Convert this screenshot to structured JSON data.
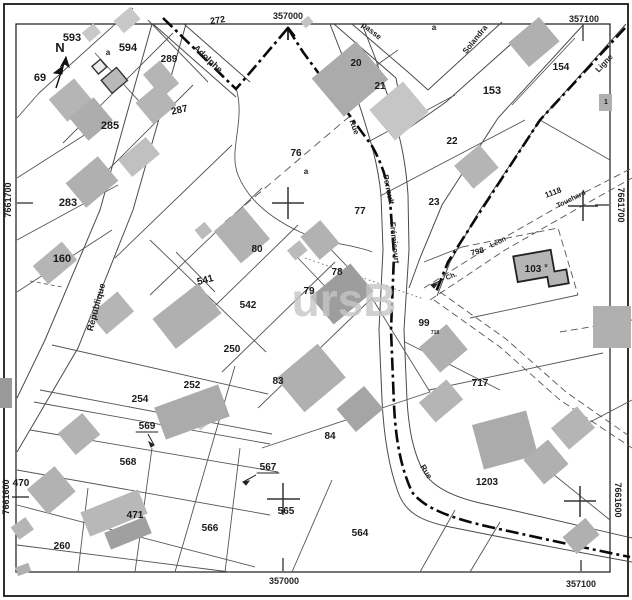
{
  "map": {
    "title": "cadastral-parcel-map",
    "watermark": {
      "text": "ursB",
      "x": 344,
      "y": 316,
      "fs": 46
    },
    "north": {
      "label": "N",
      "x": 60,
      "y": 52,
      "fs": 13
    },
    "coords": [
      {
        "t": "357000",
        "x": 288,
        "y": 19,
        "rot": 0,
        "fs": 9
      },
      {
        "t": "357100",
        "x": 584,
        "y": 22,
        "rot": 0,
        "fs": 9
      },
      {
        "t": "357000",
        "x": 284,
        "y": 584,
        "rot": 0,
        "fs": 9
      },
      {
        "t": "357100",
        "x": 581,
        "y": 587,
        "rot": 0,
        "fs": 9
      },
      {
        "t": "7661700",
        "x": 11,
        "y": 200,
        "rot": -90,
        "fs": 9
      },
      {
        "t": "7661600",
        "x": 9,
        "y": 497,
        "rot": -90,
        "fs": 9
      },
      {
        "t": "7661700",
        "x": 618,
        "y": 205,
        "rot": 90,
        "fs": 9
      },
      {
        "t": "7661600",
        "x": 615,
        "y": 500,
        "rot": 90,
        "fs": 9
      }
    ],
    "streets": [
      {
        "t": "République",
        "x": 99,
        "y": 308,
        "rot": -75,
        "fs": 9
      },
      {
        "t": "Adolphe",
        "x": 206,
        "y": 61,
        "rot": 43,
        "fs": 9
      },
      {
        "t": "passe",
        "x": 370,
        "y": 33,
        "rot": 38,
        "fs": 8
      },
      {
        "t": "Solandra",
        "x": 477,
        "y": 41,
        "rot": -51,
        "fs": 8
      },
      {
        "t": "Rue",
        "x": 352,
        "y": 128,
        "rot": 70,
        "fs": 8
      },
      {
        "t": "Perrault",
        "x": 386,
        "y": 190,
        "rot": 78,
        "fs": 8
      },
      {
        "t": "Frémicourt",
        "x": 392,
        "y": 243,
        "rot": 84,
        "fs": 8
      },
      {
        "t": "Rue",
        "x": 424,
        "y": 473,
        "rot": 58,
        "fs": 8
      },
      {
        "t": "Ligne",
        "x": 606,
        "y": 65,
        "rot": -47,
        "fs": 8
      },
      {
        "t": "Ch.",
        "x": 452,
        "y": 278,
        "rot": -22,
        "fs": 7
      },
      {
        "t": "Léon",
        "x": 499,
        "y": 244,
        "rot": -27,
        "fs": 7
      },
      {
        "t": "Touchard",
        "x": 572,
        "y": 201,
        "rot": -26,
        "fs": 7
      }
    ],
    "parcels": [
      {
        "t": "593",
        "x": 72,
        "y": 41,
        "fs": 11
      },
      {
        "t": "594",
        "x": 128,
        "y": 51,
        "fs": 11
      },
      {
        "t": "a",
        "x": 108,
        "y": 55,
        "fs": 8
      },
      {
        "t": "289",
        "x": 169,
        "y": 62,
        "fs": 10
      },
      {
        "t": "272",
        "x": 218,
        "y": 23,
        "fs": 9,
        "rot": -8
      },
      {
        "t": "69",
        "x": 40,
        "y": 81,
        "fs": 11
      },
      {
        "t": "285",
        "x": 110,
        "y": 129,
        "fs": 11
      },
      {
        "t": "287",
        "x": 180,
        "y": 113,
        "fs": 10,
        "rot": -12
      },
      {
        "t": "283",
        "x": 68,
        "y": 206,
        "fs": 11
      },
      {
        "t": "160",
        "x": 62,
        "y": 262,
        "fs": 11
      },
      {
        "t": "76",
        "x": 296,
        "y": 156,
        "fs": 10
      },
      {
        "t": "a",
        "x": 306,
        "y": 174,
        "fs": 8
      },
      {
        "t": "77",
        "x": 360,
        "y": 214,
        "fs": 10
      },
      {
        "t": "20",
        "x": 356,
        "y": 66,
        "fs": 10
      },
      {
        "t": "21",
        "x": 380,
        "y": 89,
        "fs": 10
      },
      {
        "t": "a",
        "x": 434,
        "y": 30,
        "fs": 8
      },
      {
        "t": "22",
        "x": 452,
        "y": 144,
        "fs": 10
      },
      {
        "t": "153",
        "x": 492,
        "y": 94,
        "fs": 11
      },
      {
        "t": "154",
        "x": 561,
        "y": 70,
        "fs": 10
      },
      {
        "t": "23",
        "x": 434,
        "y": 205,
        "fs": 10
      },
      {
        "t": "80",
        "x": 257,
        "y": 252,
        "fs": 10
      },
      {
        "t": "78",
        "x": 337,
        "y": 275,
        "fs": 10
      },
      {
        "t": "79",
        "x": 309,
        "y": 294,
        "fs": 10
      },
      {
        "t": "541",
        "x": 206,
        "y": 283,
        "fs": 10,
        "rot": -15
      },
      {
        "t": "542",
        "x": 248,
        "y": 308,
        "fs": 10
      },
      {
        "t": "250",
        "x": 232,
        "y": 352,
        "fs": 10
      },
      {
        "t": "252",
        "x": 192,
        "y": 388,
        "fs": 10
      },
      {
        "t": "254",
        "x": 140,
        "y": 402,
        "fs": 10
      },
      {
        "t": "569",
        "x": 147,
        "y": 429,
        "fs": 10,
        "u": true
      },
      {
        "t": "568",
        "x": 128,
        "y": 465,
        "fs": 10
      },
      {
        "t": "470",
        "x": 21,
        "y": 486,
        "fs": 10
      },
      {
        "t": "471",
        "x": 135,
        "y": 518,
        "fs": 10
      },
      {
        "t": "260",
        "x": 62,
        "y": 549,
        "fs": 10
      },
      {
        "t": "566",
        "x": 210,
        "y": 531,
        "fs": 10
      },
      {
        "t": "565",
        "x": 286,
        "y": 514,
        "fs": 10
      },
      {
        "t": "567",
        "x": 268,
        "y": 470,
        "fs": 10,
        "u": true
      },
      {
        "t": "564",
        "x": 360,
        "y": 536,
        "fs": 10
      },
      {
        "t": "83",
        "x": 278,
        "y": 384,
        "fs": 10
      },
      {
        "t": "84",
        "x": 330,
        "y": 439,
        "fs": 10
      },
      {
        "t": "99",
        "x": 424,
        "y": 326,
        "fs": 10
      },
      {
        "t": "718",
        "x": 435,
        "y": 334,
        "fs": 5
      },
      {
        "t": "717",
        "x": 480,
        "y": 386,
        "fs": 10
      },
      {
        "t": "1203",
        "x": 487,
        "y": 485,
        "fs": 10
      },
      {
        "t": "103",
        "x": 533,
        "y": 272,
        "fs": 10
      },
      {
        "t": "u",
        "x": 546,
        "y": 267,
        "fs": 5
      },
      {
        "t": "798",
        "x": 478,
        "y": 254,
        "fs": 8,
        "rot": -15
      },
      {
        "t": "1118",
        "x": 554,
        "y": 195,
        "fs": 8,
        "rot": -20
      },
      {
        "t": "1",
        "x": 606,
        "y": 104,
        "fs": 7
      }
    ]
  }
}
